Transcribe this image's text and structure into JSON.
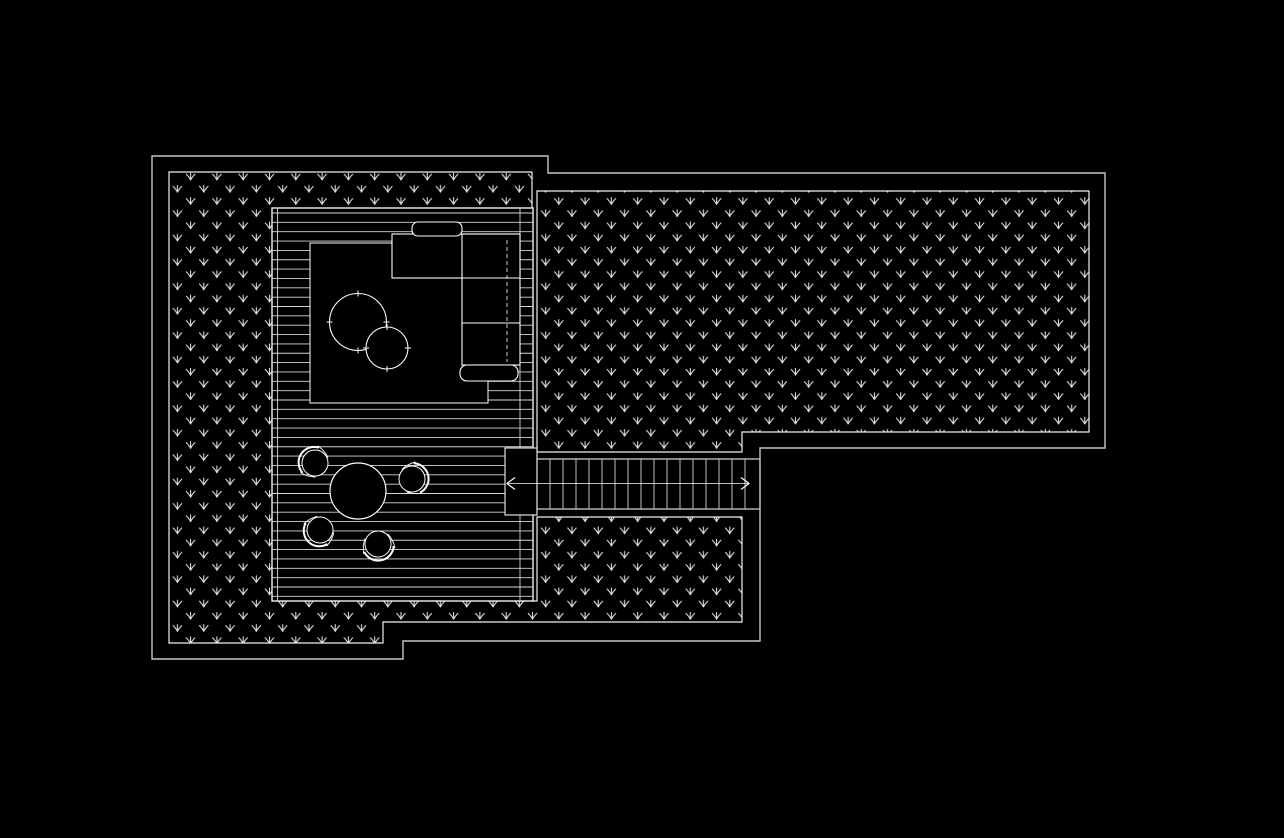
{
  "canvas": {
    "width": 1284,
    "height": 838
  },
  "colors": {
    "background": "#000000",
    "outer_line": "#c6c6c6",
    "border_line": "#f0f0f0",
    "hatch_line": "#e3e3e3",
    "board_line": "#d6d6d6",
    "furniture_line": "#fdfdfd"
  },
  "plan": {
    "outer_boundary": [
      [
        152,
        156
      ],
      [
        548,
        156
      ],
      [
        548,
        173
      ],
      [
        1105,
        173
      ],
      [
        1105,
        448
      ],
      [
        760,
        448
      ],
      [
        760,
        641
      ],
      [
        403,
        641
      ],
      [
        403,
        659
      ],
      [
        152,
        659
      ]
    ],
    "grass_pattern": {
      "tile_w": 26.3,
      "tile_h": 24.4,
      "g1x": 6.5,
      "g1y": 6.0,
      "g2x": 19.65,
      "g2y": 18.2,
      "glyph": "M0,3.2 L0,-3.6 M0,3.2 C-1.2,0.8 -2.6,-0.8 -4.3,-2.6 M0,3.2 C1.2,0.8 2.6,-0.8 4.3,-2.6"
    },
    "grass_regions": [
      {
        "name": "garden-area-left",
        "points": [
          [
            169,
            172
          ],
          [
            532,
            172
          ],
          [
            532,
            601
          ],
          [
            537,
            601
          ],
          [
            537,
            517
          ],
          [
            742,
            517
          ],
          [
            742,
            622
          ],
          [
            383,
            622
          ],
          [
            383,
            643
          ],
          [
            169,
            643
          ]
        ]
      },
      {
        "name": "garden-area-right",
        "points": [
          [
            537,
            191
          ],
          [
            1089,
            191
          ],
          [
            1089,
            432
          ],
          [
            742,
            432
          ],
          [
            742,
            452
          ],
          [
            537,
            452
          ]
        ]
      }
    ],
    "deck": {
      "x": 272,
      "y": 208,
      "w": 261,
      "h": 393,
      "board_start": 213,
      "board_spacing": 9.35,
      "inner_vlines": [
        277.5,
        520
      ]
    },
    "rug": {
      "x": 310,
      "y": 243,
      "w": 178,
      "h": 160
    },
    "coffee_tables": [
      {
        "cx": 358,
        "cy": 322,
        "r": 28.5
      },
      {
        "cx": 387,
        "cy": 348,
        "r": 21
      }
    ],
    "sofa": {
      "sections": [
        {
          "x": 392,
          "y": 234,
          "w": 128,
          "h": 44
        },
        {
          "x": 462,
          "y": 234,
          "w": 58,
          "h": 131
        }
      ],
      "back_cushion": {
        "x": 412,
        "y": 222,
        "w": 50,
        "h": 14,
        "rx": 6
      },
      "arm_cushion": {
        "x": 460,
        "y": 365,
        "w": 58,
        "h": 16,
        "rx": 7
      },
      "dividers": [
        [
          462,
          234,
          462,
          365
        ],
        [
          392,
          278,
          520,
          278
        ],
        [
          462,
          323,
          520,
          323
        ]
      ],
      "dashed_line": [
        507,
        240,
        507,
        362
      ]
    },
    "stairs": {
      "landing": {
        "x": 505,
        "y": 448,
        "w": 32,
        "h": 67
      },
      "run": {
        "x": 537,
        "y": 459,
        "w": 223,
        "h": 50
      },
      "treads": {
        "start": 550,
        "end": 745,
        "step": 13
      },
      "center_y": 483.5,
      "arrow_x1": 507,
      "arrow_x2": 749
    },
    "dining": {
      "table": {
        "cx": 358,
        "cy": 491,
        "r": 28
      },
      "chair_r": 13,
      "chair_back": "M -5,-15 A 15.5,15.5 0 0 0 -5,15",
      "chair_arms": [
        "M -7,-16 Q 2,-15.5 8,-11.5",
        "M -7,16 Q 2,15.5 8,11.5"
      ],
      "chairs": [
        {
          "cx": 315,
          "cy": 463,
          "rot": 33
        },
        {
          "cx": 412,
          "cy": 479,
          "rot": 168
        },
        {
          "cx": 320,
          "cy": 530,
          "rot": -46
        },
        {
          "cx": 378,
          "cy": 544,
          "rot": -101
        }
      ]
    }
  }
}
